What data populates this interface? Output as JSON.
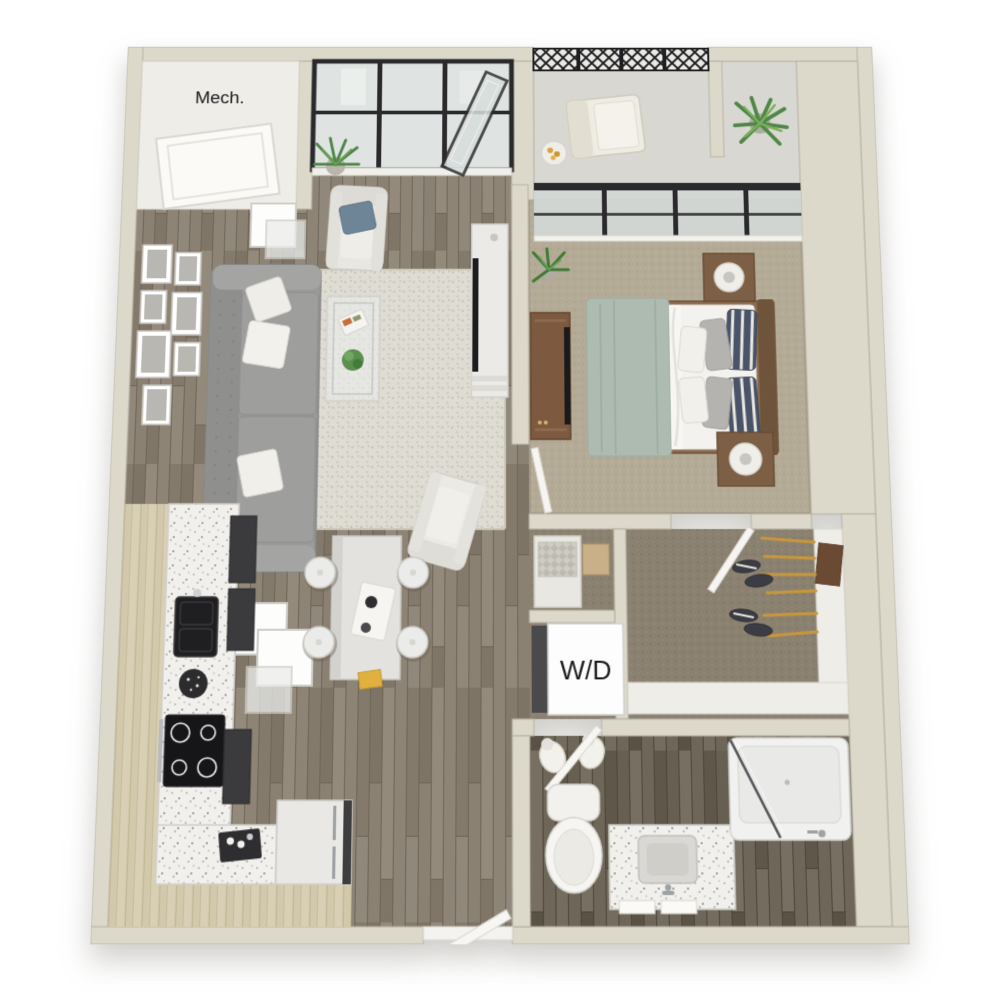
{
  "view": {
    "type": "3d-top-down-apartment-floor-plan",
    "background": "#ffffff"
  },
  "labels": {
    "mech": "Mech.",
    "wd": "W/D"
  },
  "rooms": [
    {
      "name": "mechanical-closet",
      "label": "Mech."
    },
    {
      "name": "balcony"
    },
    {
      "name": "living-room"
    },
    {
      "name": "bedroom"
    },
    {
      "name": "kitchen"
    },
    {
      "name": "hallway"
    },
    {
      "name": "linen-closet"
    },
    {
      "name": "laundry-closet",
      "label": "W/D"
    },
    {
      "name": "walk-in-closet"
    },
    {
      "name": "bathroom"
    },
    {
      "name": "entry"
    }
  ],
  "palette": {
    "wall": "#DCD8CA",
    "wall_edge": "#B7B3A4",
    "wood_floor": "#877E6F",
    "bathroom_floor": "#5F5749",
    "bedroom_carpet": "#B4AB97",
    "closet_carpet": "#8A8170",
    "balcony_floor": "#D8D7D1",
    "rug": "#DFDCD3",
    "window_frame": "#2A2A2C",
    "glass": "#D8DEDC",
    "sofa_gray": "#9A9A98",
    "bed_blanket_sage": "#AEBBB1",
    "pillow_navy": "#4A5468",
    "wood_furniture": "#7D5A3F",
    "counter_speckled": "#F2F0EC",
    "cabinet_light_wood": "#D2C9AC",
    "appliance_dark": "#2E2E30",
    "hanger_gold": "#C8963C",
    "plant_green": "#4E8747"
  }
}
